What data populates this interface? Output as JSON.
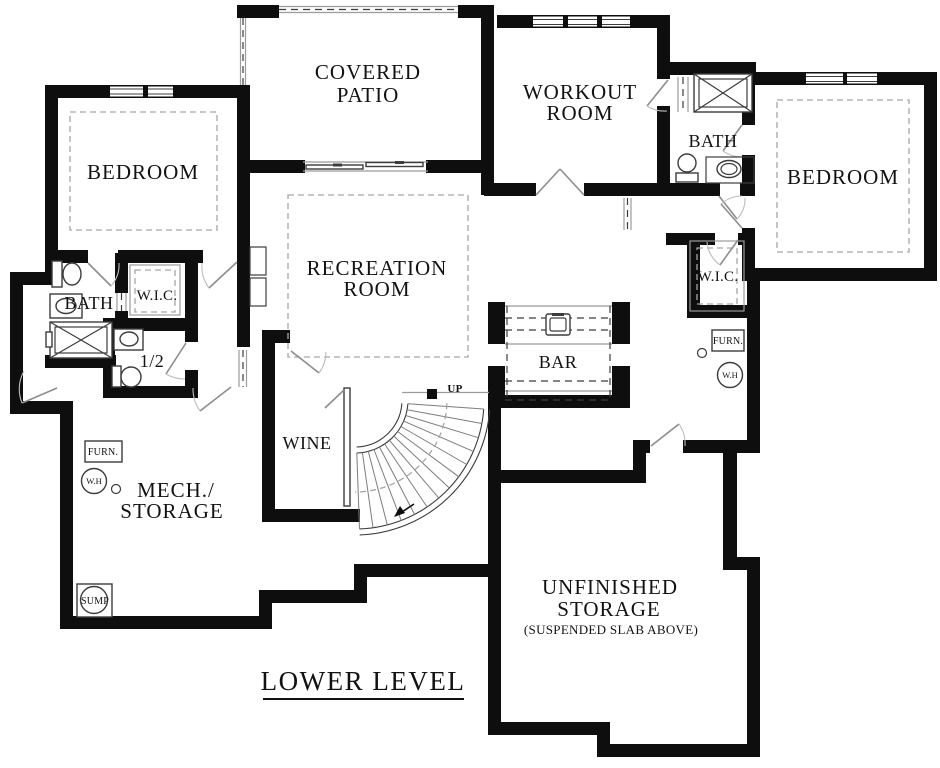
{
  "colors": {
    "background": "#ffffff",
    "wall": "#0e0e0e",
    "line": "#3c3c3c",
    "thin": "#9b9b9b",
    "text": "#121212"
  },
  "title": "LOWER LEVEL",
  "labels": {
    "bedroom_left": "BEDROOM",
    "covered_patio_line1": "COVERED",
    "covered_patio_line2": "PATIO",
    "workout_line1": "WORKOUT",
    "workout_line2": "ROOM",
    "bath_upper": "BATH",
    "bedroom_right": "BEDROOM",
    "recreation_line1": "RECREATION",
    "recreation_line2": "ROOM",
    "bath_left": "BATH",
    "wic_left": "W.I.C.",
    "half_bath": "1/2",
    "wine": "WINE",
    "mech_line1": "MECH./",
    "mech_line2": "STORAGE",
    "bar": "BAR",
    "wic_right": "W.I.C.",
    "furn_right": "FURN.",
    "water_heater_right": "W.H",
    "furn_left": "FURN.",
    "water_heater_left": "W.H",
    "sump": "SUMP",
    "stairs_up": "UP",
    "unfinished_line1": "UNFINISHED",
    "unfinished_line2": "STORAGE",
    "unfinished_line3": "(SUSPENDED SLAB ABOVE)"
  }
}
